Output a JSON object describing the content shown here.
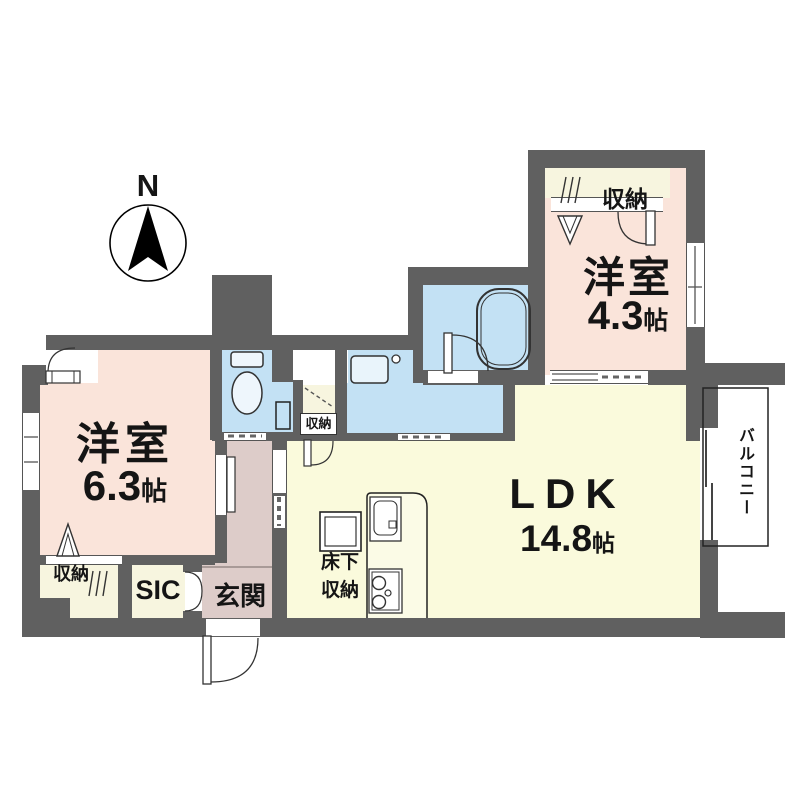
{
  "compass": {
    "label": "N"
  },
  "rooms": {
    "bedroom1": {
      "name": "洋室",
      "size": "6.3",
      "unit": "帖"
    },
    "bedroom2": {
      "name": "洋室",
      "size": "4.3",
      "unit": "帖"
    },
    "ldk": {
      "name": "LDK",
      "size": "14.8",
      "unit": "帖"
    },
    "entrance": {
      "label": "玄関"
    },
    "shoe_closet": {
      "label": "SIC"
    },
    "balcony": {
      "label": "バルコニー"
    },
    "closet_top_right": {
      "label": "収納"
    },
    "closet_bedroom1": {
      "label": "収納"
    },
    "closet_hallway": {
      "label": "収納"
    },
    "underfloor_storage": {
      "line1": "床下",
      "line2": "収納"
    }
  },
  "colors": {
    "wall": "#606060",
    "room_pink": "#FAE4DA",
    "ldk_yellow": "#FAFADC",
    "wet_blue": "#C3E1F4",
    "hall_mauve": "#DDCCC9",
    "closet_cream": "#F7F5DF"
  }
}
